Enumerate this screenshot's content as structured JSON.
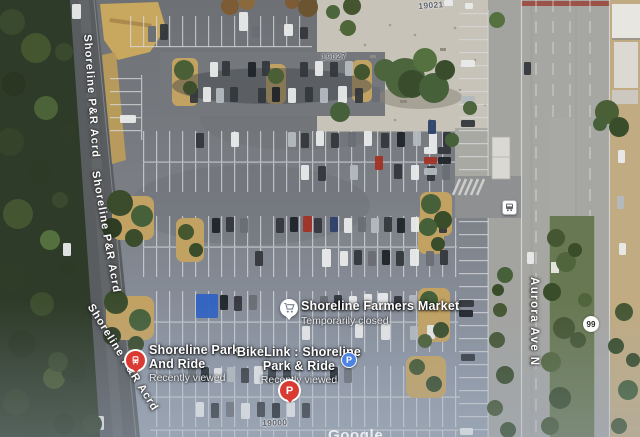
{
  "map": {
    "watermark": "Google",
    "street_labels": {
      "shoreline_acrd": "Shoreline P&R Acrd",
      "aurora": "Aurora Ave N",
      "route_shield": "99"
    },
    "address_numbers": [
      "19021",
      "19027",
      "19000"
    ],
    "pois": {
      "farmers_market": {
        "title": "Shoreline Farmers Market",
        "subtitle": "Temporarily closed"
      },
      "park_and_ride": {
        "title_line1": "Shoreline Park",
        "title_line2": "And Ride",
        "subtitle": "Recently viewed"
      },
      "bikelink": {
        "title_line1": "BikeLink : Shoreline",
        "title_line2": "Park & Ride",
        "subtitle": "Recently viewed"
      }
    },
    "icons": {
      "parking_letter": "P"
    },
    "colors": {
      "marker_red": "#d93a32",
      "parking_blue": "#4f83e3",
      "label_white": "#ffffff",
      "address_grey": "#5d626b"
    }
  },
  "decor": {
    "car_colors": {
      "W": "#e9eaea",
      "S": "#b4b9bf",
      "D": "#34383d",
      "K": "#1f2429",
      "R": "#a23124",
      "G": "#696e74",
      "N": "#2e4169",
      "B": "#2f62c2"
    },
    "cars": [
      [
        72,
        4,
        9,
        15,
        "W"
      ],
      [
        120,
        115,
        16,
        8,
        "W"
      ],
      [
        148,
        26,
        8,
        16,
        "G"
      ],
      [
        160,
        24,
        8,
        16,
        "D"
      ],
      [
        239,
        12,
        9,
        19,
        "W"
      ],
      [
        252,
        25,
        8,
        13,
        "G"
      ],
      [
        284,
        24,
        9,
        12,
        "W"
      ],
      [
        300,
        27,
        8,
        12,
        "D"
      ],
      [
        210,
        62,
        8,
        15,
        "W"
      ],
      [
        222,
        61,
        8,
        15,
        "D"
      ],
      [
        248,
        62,
        8,
        15,
        "K"
      ],
      [
        262,
        61,
        8,
        15,
        "D"
      ],
      [
        300,
        62,
        8,
        15,
        "D"
      ],
      [
        315,
        61,
        8,
        15,
        "W"
      ],
      [
        330,
        62,
        8,
        15,
        "D"
      ],
      [
        345,
        61,
        8,
        15,
        "S"
      ],
      [
        190,
        88,
        8,
        15,
        "D"
      ],
      [
        203,
        87,
        8,
        15,
        "W"
      ],
      [
        216,
        88,
        8,
        15,
        "S"
      ],
      [
        230,
        87,
        8,
        15,
        "D"
      ],
      [
        258,
        88,
        8,
        15,
        "D"
      ],
      [
        272,
        87,
        8,
        15,
        "K"
      ],
      [
        288,
        88,
        8,
        15,
        "W"
      ],
      [
        305,
        87,
        8,
        15,
        "D"
      ],
      [
        320,
        88,
        8,
        15,
        "S"
      ],
      [
        338,
        86,
        9,
        17,
        "W"
      ],
      [
        355,
        88,
        8,
        15,
        "D"
      ],
      [
        372,
        87,
        8,
        15,
        "G"
      ],
      [
        196,
        133,
        8,
        15,
        "D"
      ],
      [
        231,
        132,
        8,
        15,
        "W"
      ],
      [
        288,
        132,
        8,
        15,
        "S"
      ],
      [
        301,
        133,
        8,
        15,
        "D"
      ],
      [
        316,
        131,
        8,
        15,
        "W"
      ],
      [
        331,
        133,
        8,
        15,
        "D"
      ],
      [
        348,
        132,
        8,
        15,
        "G"
      ],
      [
        364,
        131,
        8,
        15,
        "W"
      ],
      [
        381,
        133,
        8,
        15,
        "D"
      ],
      [
        397,
        132,
        8,
        15,
        "K"
      ],
      [
        413,
        131,
        8,
        15,
        "S"
      ],
      [
        429,
        133,
        8,
        15,
        "W"
      ],
      [
        443,
        132,
        8,
        15,
        "D"
      ],
      [
        301,
        165,
        8,
        15,
        "W"
      ],
      [
        318,
        166,
        8,
        15,
        "D"
      ],
      [
        350,
        165,
        8,
        15,
        "S"
      ],
      [
        375,
        156,
        8,
        14,
        "R"
      ],
      [
        394,
        164,
        8,
        15,
        "D"
      ],
      [
        411,
        165,
        8,
        15,
        "W"
      ],
      [
        427,
        166,
        8,
        15,
        "D"
      ],
      [
        442,
        165,
        8,
        15,
        "G"
      ],
      [
        424,
        147,
        13,
        7,
        "W"
      ],
      [
        438,
        147,
        13,
        7,
        "D"
      ],
      [
        424,
        157,
        13,
        7,
        "R"
      ],
      [
        438,
        157,
        13,
        7,
        "K"
      ],
      [
        424,
        168,
        13,
        7,
        "S"
      ],
      [
        428,
        120,
        8,
        14,
        "N"
      ],
      [
        212,
        218,
        8,
        15,
        "K"
      ],
      [
        226,
        217,
        8,
        15,
        "D"
      ],
      [
        240,
        218,
        8,
        15,
        "G"
      ],
      [
        276,
        218,
        8,
        15,
        "D"
      ],
      [
        290,
        217,
        8,
        15,
        "K"
      ],
      [
        303,
        216,
        9,
        16,
        "R"
      ],
      [
        314,
        218,
        8,
        15,
        "D"
      ],
      [
        330,
        217,
        8,
        15,
        "N"
      ],
      [
        344,
        218,
        8,
        15,
        "W"
      ],
      [
        358,
        217,
        8,
        15,
        "G"
      ],
      [
        371,
        218,
        8,
        15,
        "S"
      ],
      [
        384,
        217,
        8,
        15,
        "D"
      ],
      [
        397,
        218,
        8,
        15,
        "K"
      ],
      [
        411,
        217,
        8,
        15,
        "W"
      ],
      [
        425,
        218,
        8,
        15,
        "S"
      ],
      [
        439,
        218,
        8,
        15,
        "D"
      ],
      [
        255,
        251,
        8,
        15,
        "D"
      ],
      [
        322,
        249,
        9,
        18,
        "W"
      ],
      [
        340,
        251,
        8,
        15,
        "W"
      ],
      [
        354,
        250,
        8,
        15,
        "D"
      ],
      [
        368,
        251,
        8,
        15,
        "G"
      ],
      [
        382,
        250,
        8,
        15,
        "K"
      ],
      [
        396,
        251,
        8,
        15,
        "D"
      ],
      [
        410,
        249,
        9,
        17,
        "W"
      ],
      [
        426,
        251,
        8,
        15,
        "G"
      ],
      [
        440,
        250,
        8,
        15,
        "D"
      ],
      [
        196,
        294,
        22,
        24,
        "B"
      ],
      [
        220,
        295,
        8,
        15,
        "K"
      ],
      [
        234,
        296,
        8,
        15,
        "D"
      ],
      [
        249,
        295,
        8,
        15,
        "G"
      ],
      [
        320,
        296,
        8,
        14,
        "G"
      ],
      [
        334,
        295,
        8,
        14,
        "D"
      ],
      [
        349,
        296,
        8,
        14,
        "W"
      ],
      [
        364,
        294,
        8,
        15,
        "W"
      ],
      [
        378,
        293,
        10,
        17,
        "W"
      ],
      [
        394,
        296,
        8,
        14,
        "D"
      ],
      [
        409,
        295,
        8,
        14,
        "S"
      ],
      [
        424,
        296,
        8,
        14,
        "D"
      ],
      [
        302,
        326,
        8,
        14,
        "W"
      ],
      [
        355,
        324,
        8,
        14,
        "W"
      ],
      [
        381,
        324,
        9,
        16,
        "W"
      ],
      [
        410,
        326,
        8,
        14,
        "S"
      ],
      [
        427,
        325,
        8,
        14,
        "W"
      ],
      [
        188,
        368,
        8,
        15,
        "G"
      ],
      [
        201,
        367,
        8,
        15,
        "K"
      ],
      [
        214,
        368,
        8,
        15,
        "W"
      ],
      [
        227,
        367,
        8,
        15,
        "S"
      ],
      [
        241,
        368,
        8,
        15,
        "D"
      ],
      [
        254,
        366,
        9,
        18,
        "W"
      ],
      [
        268,
        368,
        8,
        15,
        "D"
      ],
      [
        283,
        367,
        8,
        15,
        "D"
      ],
      [
        330,
        367,
        8,
        15,
        "K"
      ],
      [
        344,
        368,
        8,
        15,
        "G"
      ],
      [
        196,
        402,
        8,
        15,
        "W"
      ],
      [
        211,
        403,
        8,
        15,
        "D"
      ],
      [
        226,
        402,
        8,
        15,
        "G"
      ],
      [
        241,
        403,
        9,
        16,
        "W"
      ],
      [
        257,
        402,
        8,
        15,
        "D"
      ],
      [
        272,
        403,
        8,
        15,
        "K"
      ],
      [
        287,
        402,
        8,
        15,
        "W"
      ],
      [
        302,
        403,
        8,
        15,
        "D"
      ],
      [
        461,
        60,
        14,
        7,
        "W"
      ],
      [
        461,
        96,
        14,
        7,
        "S"
      ],
      [
        461,
        120,
        14,
        7,
        "D"
      ],
      [
        459,
        300,
        15,
        7,
        "D"
      ],
      [
        459,
        310,
        14,
        7,
        "K"
      ],
      [
        461,
        354,
        14,
        7,
        "D"
      ],
      [
        460,
        428,
        13,
        7,
        "W"
      ],
      [
        63,
        243,
        8,
        13,
        "W"
      ],
      [
        95,
        416,
        9,
        14,
        "W"
      ],
      [
        524,
        62,
        7,
        13,
        "D"
      ],
      [
        527,
        252,
        7,
        12,
        "W"
      ],
      [
        618,
        150,
        7,
        13,
        "W"
      ],
      [
        617,
        196,
        7,
        13,
        "S"
      ],
      [
        619,
        243,
        7,
        12,
        "W"
      ],
      [
        240,
        0,
        8,
        5,
        "W"
      ],
      [
        444,
        0,
        9,
        6,
        "W"
      ],
      [
        465,
        3,
        8,
        6,
        "W"
      ]
    ]
  }
}
